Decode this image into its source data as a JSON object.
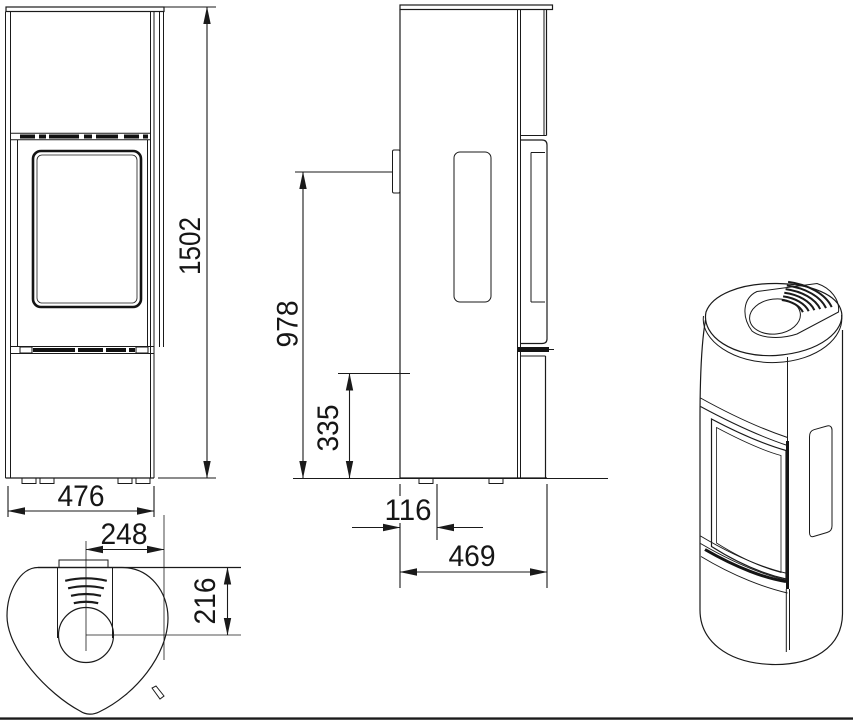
{
  "colors": {
    "background": "#ffffff",
    "line": "#1a1a1a"
  },
  "dimensions_mm": {
    "total_height": "1502",
    "front_width": "476",
    "flue_center_offset": "248",
    "flue_center_from_back_top": "216",
    "rear_outlet_upper_height": "978",
    "rear_outlet_lower_height": "335",
    "offset_from_back": "116",
    "depth": "469"
  }
}
